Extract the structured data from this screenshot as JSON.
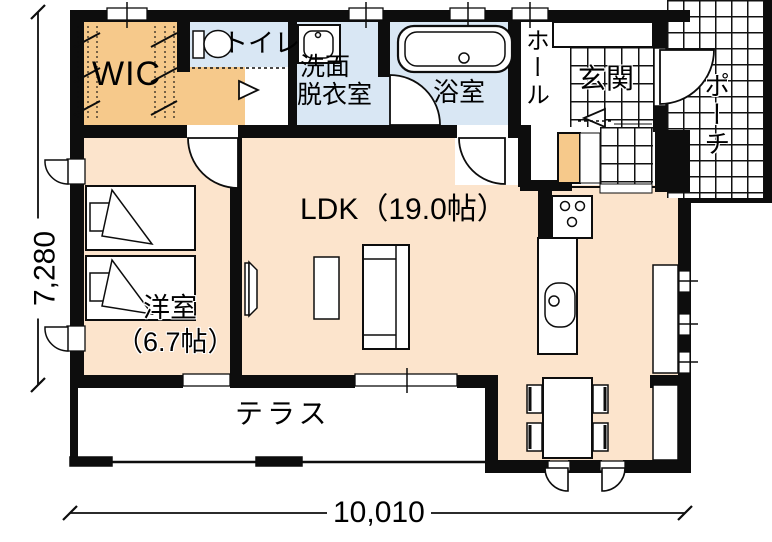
{
  "rooms": {
    "wic": {
      "label": "WIC"
    },
    "toilet": {
      "label": "トイレ"
    },
    "washroom": {
      "label_line1": "洗面",
      "label_line2": "脱衣室"
    },
    "bathroom": {
      "label": "浴室"
    },
    "hall": {
      "label": "ホール"
    },
    "entrance": {
      "label": "玄関"
    },
    "porch": {
      "label": "ポーチ"
    },
    "ldk": {
      "label": "LDK（19.0帖）"
    },
    "bedroom": {
      "name": "洋室",
      "size": "（6.7帖）"
    },
    "terrace": {
      "label": "テラス"
    }
  },
  "dimensions": {
    "width_mm": "10,010",
    "height_mm": "7,280"
  },
  "icons": [
    "bathtub-icon",
    "toilet-icon",
    "washbasin-icon",
    "stove-icon",
    "kitchen-sink-icon",
    "bed-icon",
    "sofa-icon",
    "tv-icon",
    "dining-table-icon",
    "chair-icon",
    "door-swing-icon",
    "window-icon"
  ],
  "colors": {
    "floor_peach": "#fce4cc",
    "closet_orange": "#f6c98b",
    "wet_area_blue": "#d9e7f4",
    "wall_black": "#0d0d0d"
  }
}
